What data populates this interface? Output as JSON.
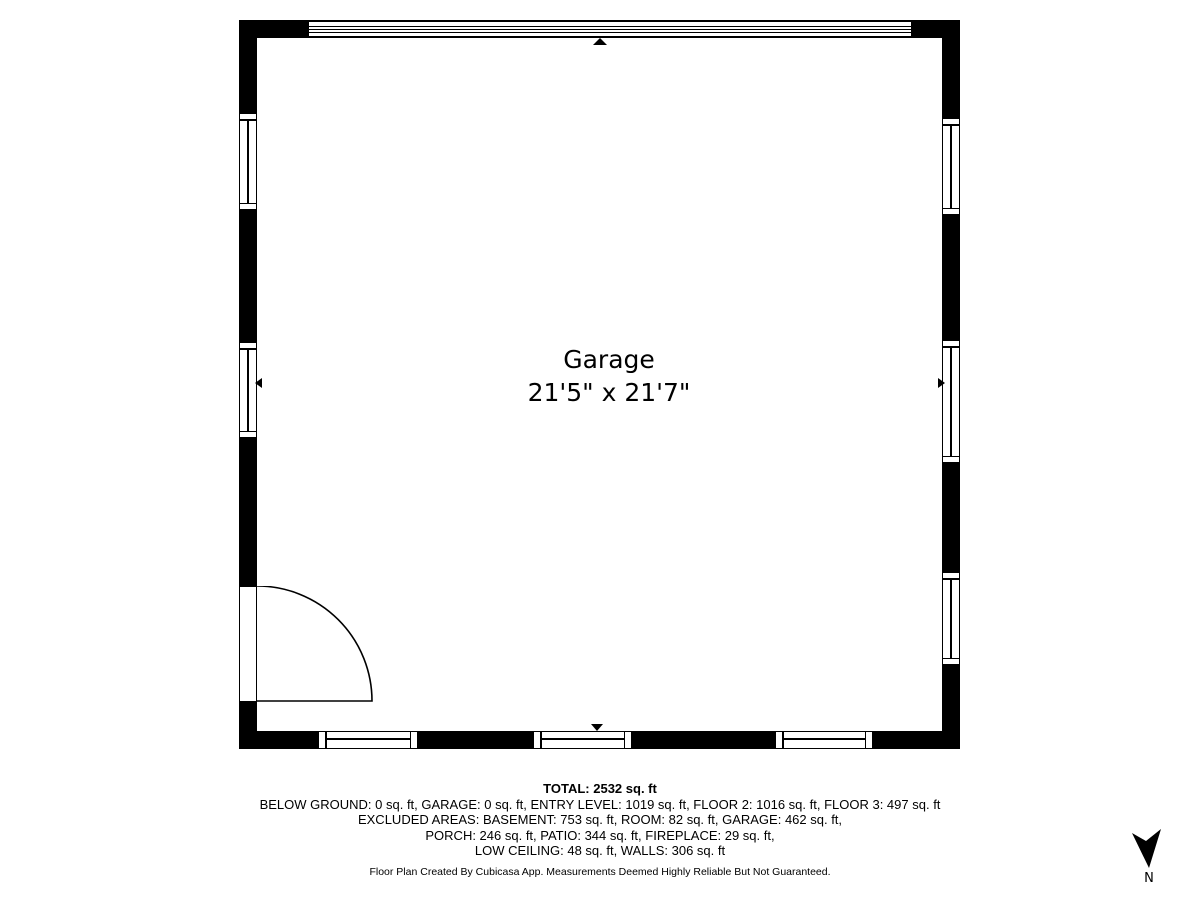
{
  "room": {
    "name": "Garage",
    "dimensions": "21'5\" x 21'7\""
  },
  "summary": {
    "total": "TOTAL: 2532 sq. ft",
    "lines": [
      "BELOW GROUND: 0 sq. ft, GARAGE: 0 sq. ft, ENTRY LEVEL: 1019 sq. ft, FLOOR 2: 1016 sq. ft, FLOOR 3: 497 sq. ft",
      "EXCLUDED AREAS: BASEMENT: 753 sq. ft, ROOM: 82 sq. ft, GARAGE: 462 sq. ft,",
      "PORCH: 246 sq. ft, PATIO: 344 sq. ft, FIREPLACE: 29 sq. ft,",
      "LOW CEILING: 48 sq. ft, WALLS: 306 sq. ft"
    ]
  },
  "areas": {
    "total_sqft": 2532,
    "below_ground_sqft": 0,
    "garage_sqft": 0,
    "entry_level_sqft": 1019,
    "floor_2_sqft": 1016,
    "floor_3_sqft": 497,
    "excluded": {
      "basement_sqft": 753,
      "room_sqft": 82,
      "garage_sqft": 462,
      "porch_sqft": 246,
      "patio_sqft": 344,
      "fireplace_sqft": 29,
      "low_ceiling_sqft": 48,
      "walls_sqft": 306
    }
  },
  "disclaimer": "Floor Plan Created By Cubicasa App. Measurements Deemed Highly Reliable But Not Guaranteed.",
  "compass": {
    "label": "N"
  },
  "colors": {
    "wall": "#000000",
    "background": "#ffffff",
    "text": "#000000"
  }
}
